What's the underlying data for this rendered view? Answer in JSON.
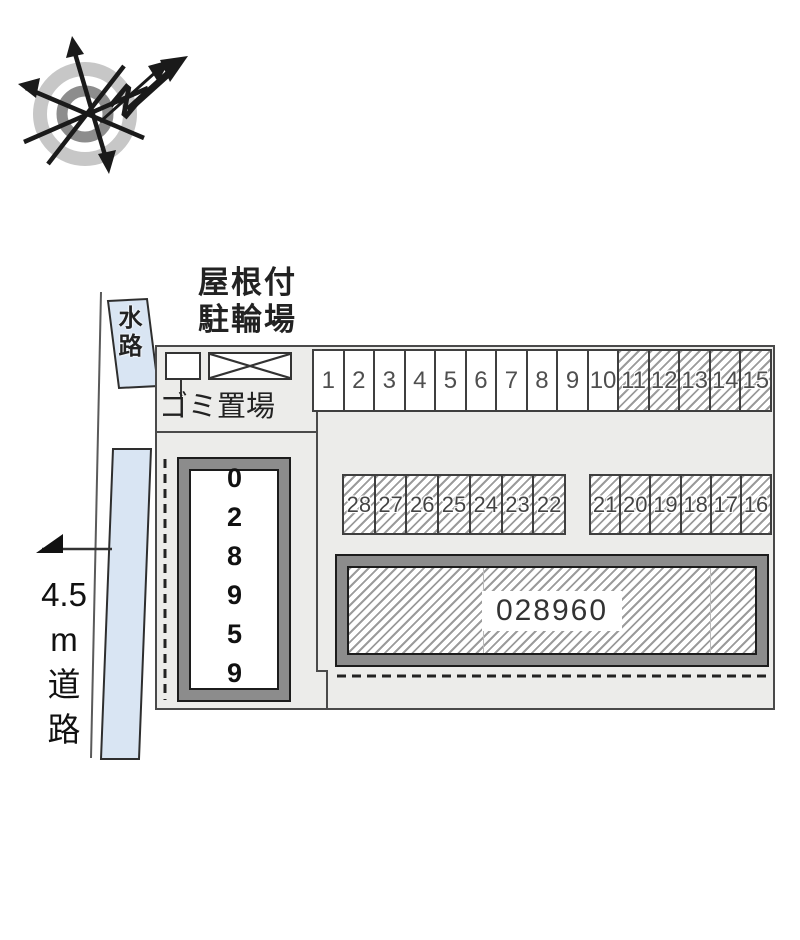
{
  "compass": {
    "north_label": "N"
  },
  "annotations": {
    "covered_bike_parking": [
      "屋根付",
      "駐輪場"
    ],
    "waterway": "水路",
    "garbage_area": "ゴミ置場",
    "road": [
      "4.5",
      "m",
      "道",
      "路"
    ]
  },
  "site_map": {
    "buildings": {
      "vertical": {
        "id": "028959"
      },
      "horizontal": {
        "id": "028960"
      }
    },
    "parking": {
      "top_row": [
        {
          "label": "1",
          "hatched": false
        },
        {
          "label": "2",
          "hatched": false
        },
        {
          "label": "3",
          "hatched": false
        },
        {
          "label": "4",
          "hatched": false
        },
        {
          "label": "5",
          "hatched": false
        },
        {
          "label": "6",
          "hatched": false
        },
        {
          "label": "7",
          "hatched": false
        },
        {
          "label": "8",
          "hatched": false
        },
        {
          "label": "9",
          "hatched": false
        },
        {
          "label": "10",
          "hatched": false
        },
        {
          "label": "11",
          "hatched": true
        },
        {
          "label": "12",
          "hatched": true
        },
        {
          "label": "13",
          "hatched": true
        },
        {
          "label": "14",
          "hatched": true
        },
        {
          "label": "15",
          "hatched": true
        }
      ],
      "middle_left_row": [
        {
          "label": "28",
          "hatched": true
        },
        {
          "label": "27",
          "hatched": true
        },
        {
          "label": "26",
          "hatched": true
        },
        {
          "label": "25",
          "hatched": true
        },
        {
          "label": "24",
          "hatched": true
        },
        {
          "label": "23",
          "hatched": true
        },
        {
          "label": "22",
          "hatched": true
        }
      ],
      "middle_right_row": [
        {
          "label": "21",
          "hatched": true
        },
        {
          "label": "20",
          "hatched": true
        },
        {
          "label": "19",
          "hatched": true
        },
        {
          "label": "18",
          "hatched": true
        },
        {
          "label": "17",
          "hatched": true
        },
        {
          "label": "16",
          "hatched": true
        }
      ]
    }
  },
  "colors": {
    "water": "#d9e5f3",
    "map_background": "#ececea",
    "hatch_line": "#9b9b9b",
    "building_frame": "#8c8c8c"
  }
}
